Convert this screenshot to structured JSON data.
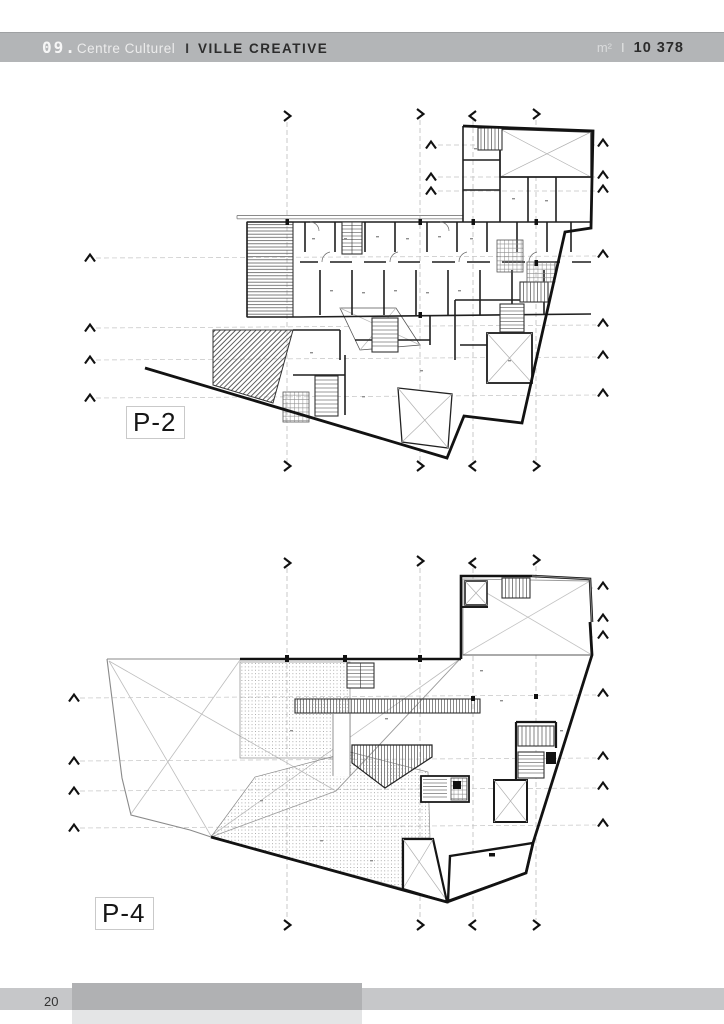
{
  "header": {
    "index": "09.",
    "title": "Centre Culturel",
    "separator": "I",
    "subtitle": "VILLE CREATIVE",
    "area_unit": "m²",
    "area_separator": "I",
    "area_value": "10 378",
    "bar_color": "#b3b5b7"
  },
  "plans": [
    {
      "label": "P-2"
    },
    {
      "label": "P-4"
    }
  ],
  "footer": {
    "page_number": "20"
  },
  "colors": {
    "wall": "#141414",
    "grid_line": "#bcbcbc",
    "hatch": "#6a6a6a",
    "stipple": "#a5a5a5"
  }
}
